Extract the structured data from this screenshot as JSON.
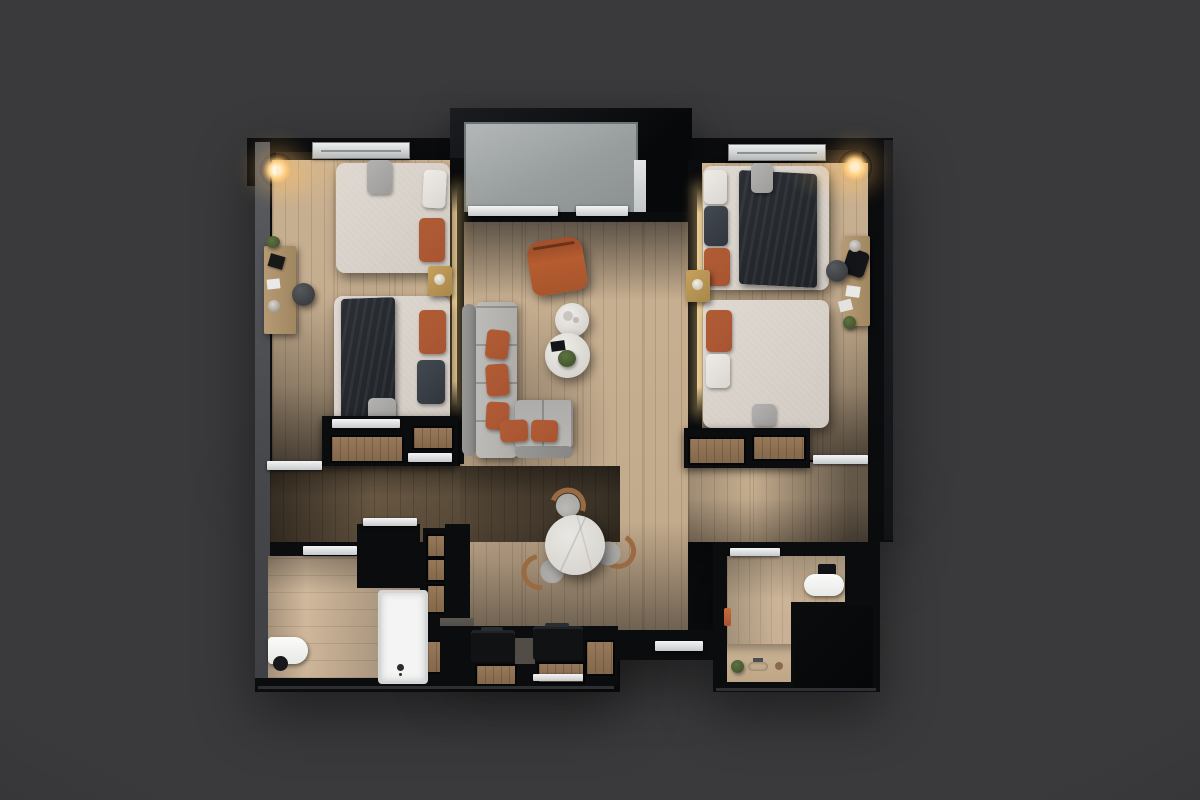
{
  "scene": {
    "title": "Top-down 3D render of a two-bedroom apartment floor plan",
    "view": "orthographic top view, photorealistic, dark studio backdrop",
    "text_visible": "none"
  },
  "palette": {
    "bg": "#3a3a3c",
    "wall": "#0b0c0e",
    "wood": "#c0a88a",
    "tile": "#cdb599",
    "entry_floor": "#9aa0a0",
    "sill": "#e8eaeb",
    "bedding": "#d0c9c1",
    "throw_dark": "#1f2226",
    "orange": "#a85432",
    "sofa_gray": "#b4b3b0",
    "marble": "#d7d4cf",
    "brass": "#a8874a",
    "glow": "#ffd489",
    "plant": "#44552f"
  },
  "rooms": [
    {
      "id": "entry",
      "label": "Entry / lift lobby",
      "furniture": [
        "grey landing floor",
        "threshold sills"
      ]
    },
    {
      "id": "bedroom-left",
      "label": "Left bedroom",
      "furniture": [
        "double bed with grey throw",
        "double bed with dark throw",
        "brass nightstand with lamp",
        "writing desk",
        "pouf",
        "wardrobe row",
        "ceiling light",
        "LED headboard strip",
        "window"
      ]
    },
    {
      "id": "living-room",
      "label": "Living room",
      "furniture": [
        "L-shaped grey sofa with orange cushions",
        "orange leather lounge chair",
        "two round nesting coffee tables with plant",
        "round marble dining table",
        "three dining chairs"
      ]
    },
    {
      "id": "bedroom-right",
      "label": "Right bedroom",
      "furniture": [
        "double bed with navy throw",
        "double bed with orange pillow",
        "brass nightstand with lamp",
        "writing desk",
        "pouf",
        "wardrobe row",
        "ceiling light",
        "LED headboard strip",
        "window"
      ]
    },
    {
      "id": "kitchenette",
      "label": "Kitchenette / hallway storage",
      "furniture": [
        "dark counter units",
        "shelf column",
        "luggage benches"
      ]
    },
    {
      "id": "bathroom-left",
      "label": "Left bathroom",
      "furniture": [
        "bathtub with floor faucet",
        "wall-hung toilet",
        "dark storage column"
      ]
    },
    {
      "id": "bathroom-right",
      "label": "Right bathroom",
      "furniture": [
        "toilet",
        "dark walk-in shower",
        "vanity with basin and plant",
        "orange towel"
      ]
    }
  ]
}
